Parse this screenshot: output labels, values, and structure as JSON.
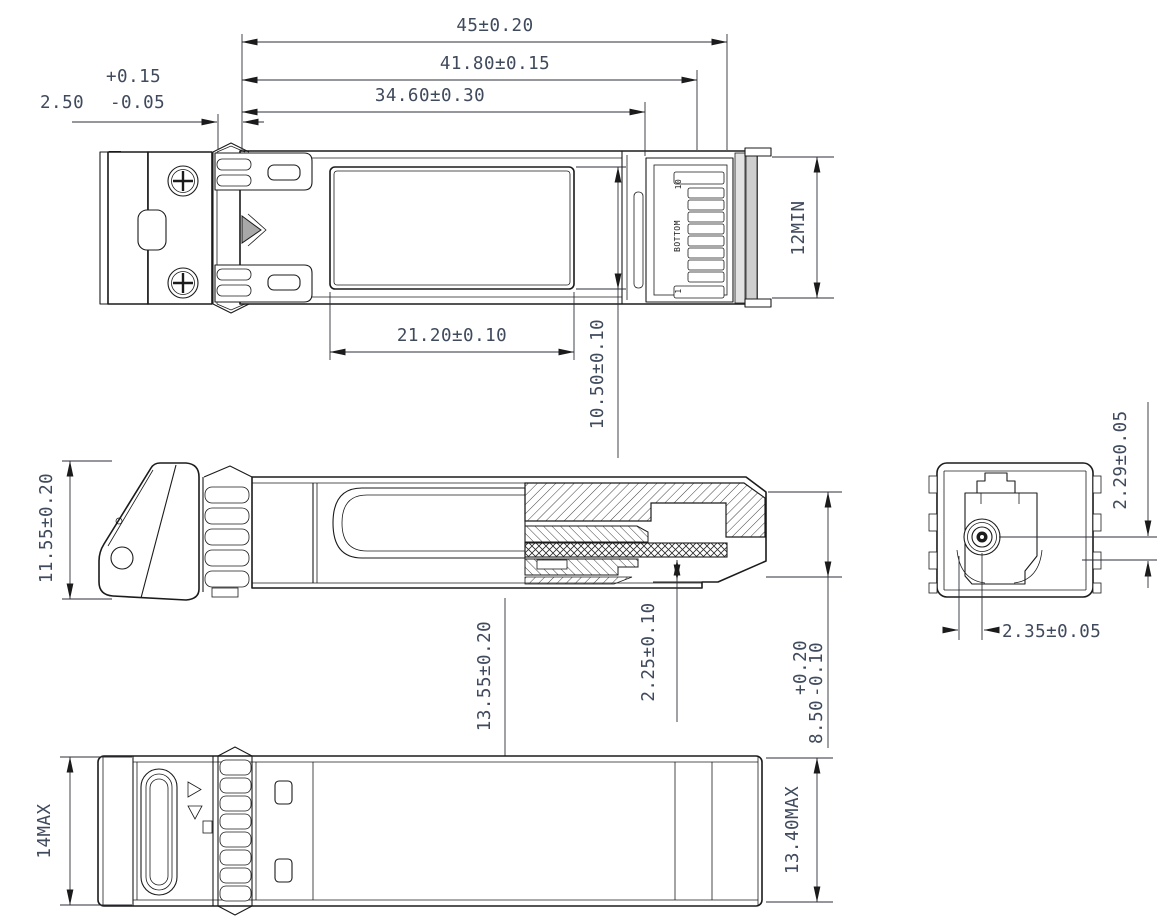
{
  "drawing": {
    "dims": {
      "overall_length": "45±0.20",
      "housing_length": "41.80±0.15",
      "body_length": "34.60±0.30",
      "latch_band_value": "2.50",
      "latch_band_plus": "+0.15",
      "latch_band_minus": "-0.05",
      "pcb_pad_length_min": "12MIN",
      "label_area_length": "21.20±0.10",
      "label_area_width": "10.50±0.10",
      "front_height": "11.55±0.20",
      "module_width": "13.55±0.20",
      "pcb_clearance": "2.25±0.10",
      "rear_height_value": "8.50",
      "rear_height_plus": "+0.20",
      "rear_height_minus": "-0.10",
      "ferrule_center_vertical": "2.29±0.05",
      "ferrule_center_horizontal": "2.35±0.05",
      "overall_height_max": "14MAX",
      "overall_width_max": "13.40MAX"
    },
    "connector": {
      "pin_last": "10",
      "pin_first": "1",
      "orientation_label": "BOTTOM"
    },
    "colors": {
      "line": "#1b1b1b",
      "dimension_text": "#3f4a5c"
    }
  }
}
